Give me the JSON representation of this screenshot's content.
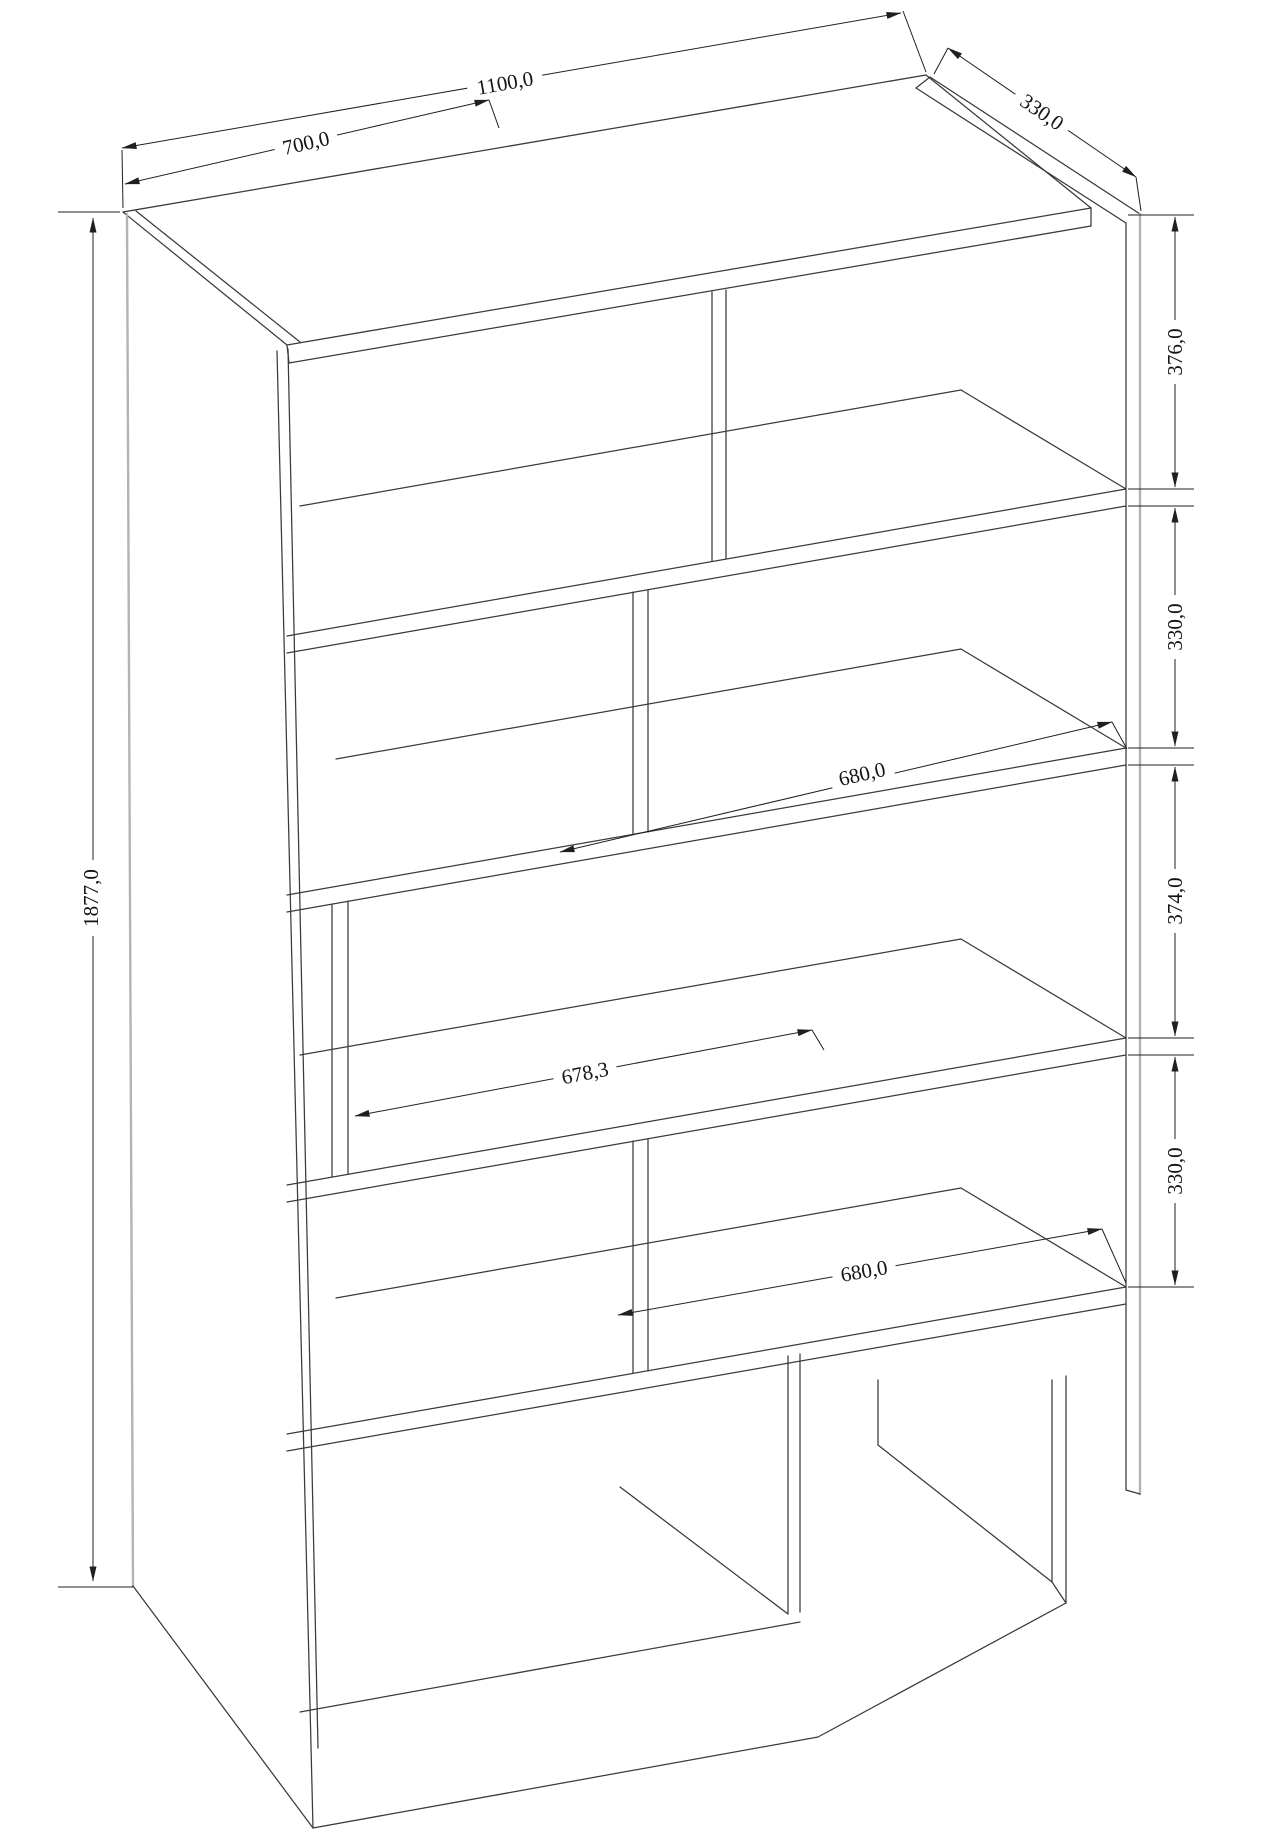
{
  "drawing": {
    "type": "furniture-technical-drawing",
    "dims": {
      "overall_width": "1100,0",
      "upper_section_width": "700,0",
      "depth": "330,0",
      "right_seg_1": "376,0",
      "right_seg_2": "330,0",
      "right_seg_3": "374,0",
      "right_seg_4": "330,0",
      "opening_upper": "680,0",
      "opening_middle": "678,3",
      "opening_lower": "680,0",
      "overall_height": "1877,0"
    },
    "colors": {
      "background": "#ffffff",
      "edge_line": "#3a3a3a",
      "light_edge": "#b3b3b3",
      "dimension_line": "#1f1f1f",
      "label_text": "#141414"
    }
  }
}
